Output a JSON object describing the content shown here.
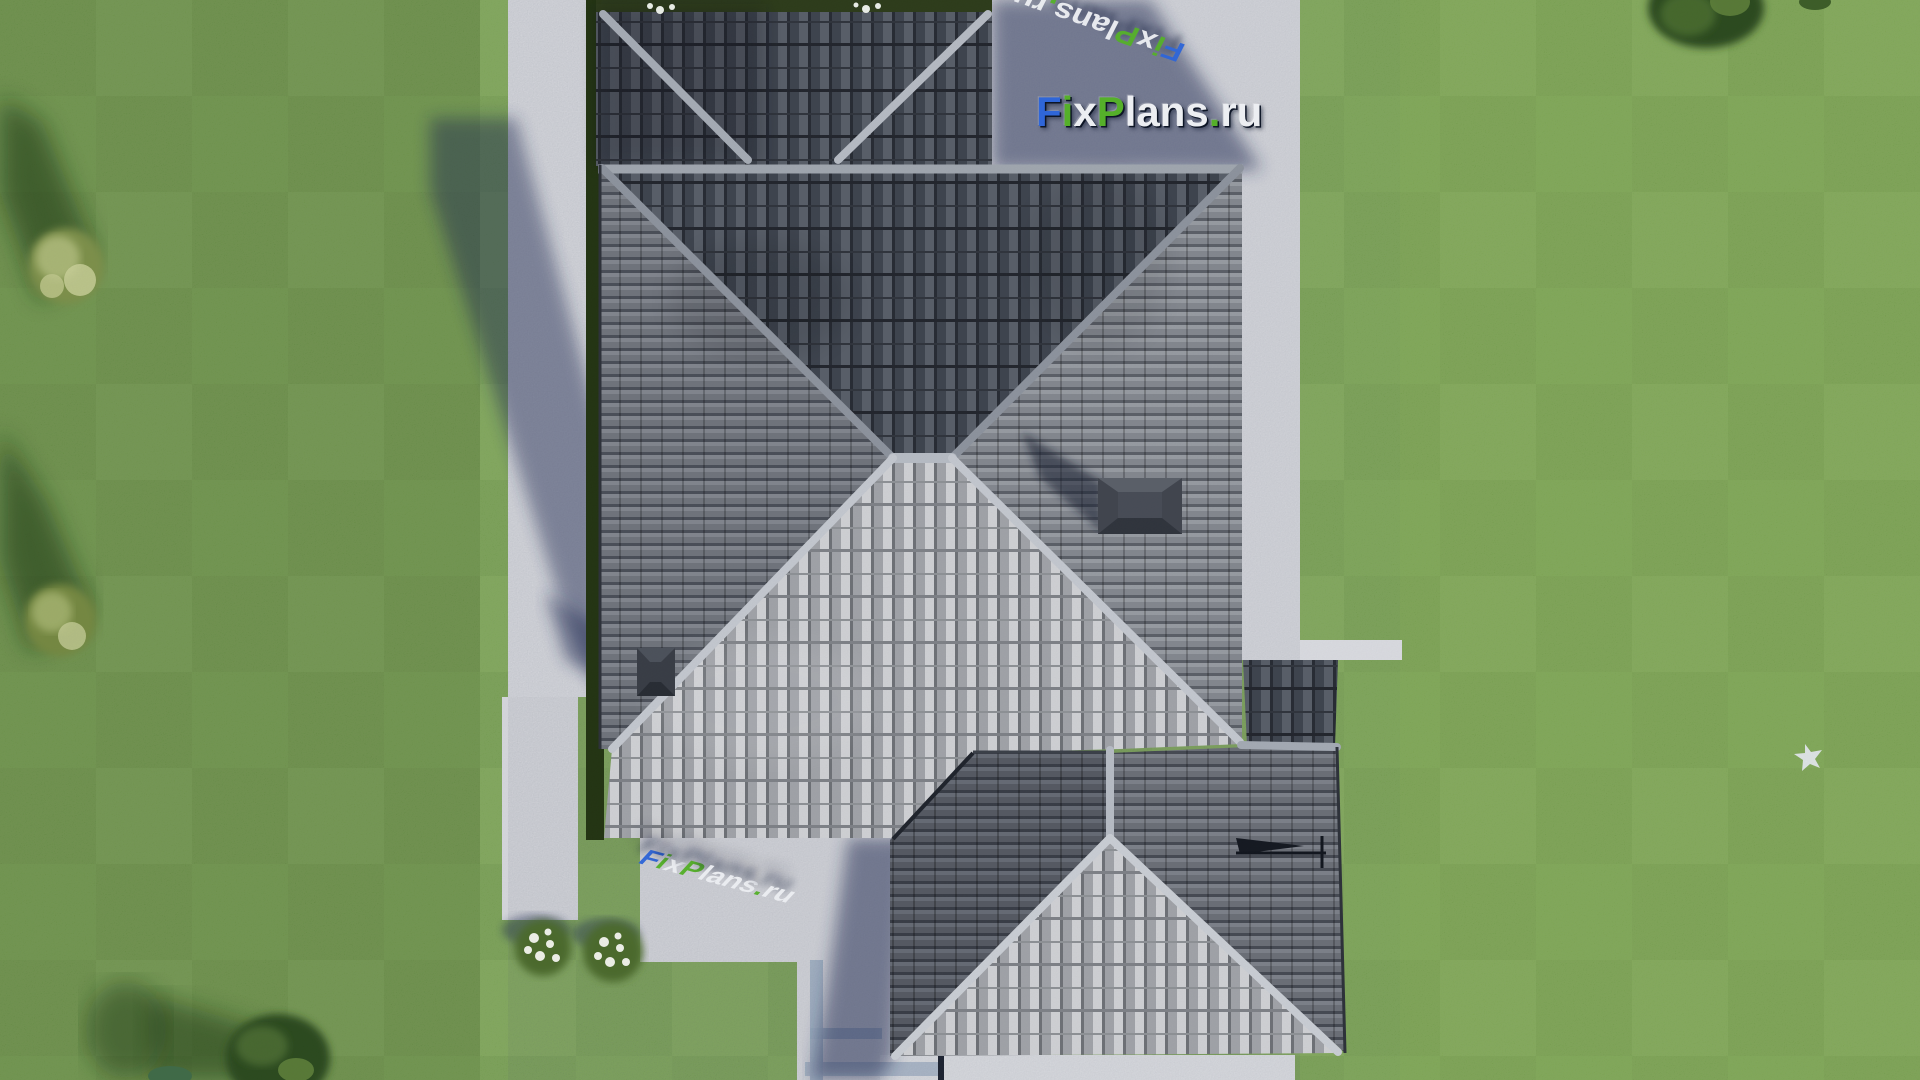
{
  "watermark": {
    "text": "FixPlans.ru",
    "segments": [
      {
        "text": "F",
        "css": "color:#2f66d8"
      },
      {
        "text": "i",
        "css": "color:#55b02a"
      },
      {
        "text": "x",
        "css": "color:#eceef2"
      },
      {
        "text": "P",
        "css": "color:#55b02a"
      },
      {
        "text": "lans",
        "css": "color:#eceef2"
      },
      {
        "text": ".",
        "css": "color:#55b02a"
      },
      {
        "text": "ru",
        "css": "color:#eceef2"
      }
    ],
    "colors": {
      "blue": "#2f66d8",
      "green": "#55b02a",
      "white": "#eceef2",
      "outline": "#101a2e"
    }
  },
  "palette": {
    "grass": "#6e9943",
    "grass_shaded": "#5c8a3a",
    "pavement": "#dcdde2",
    "cobble_path": "#9fb0c6",
    "shadow": "#1d2750",
    "roof_dark_slope": "#3d434d",
    "roof_bright_slope": "#c9cbce",
    "roof_medium_slope": "#84888f",
    "ridge_cap": "#c6cad1",
    "hedge": "#223310"
  },
  "objects": [
    "garage-hip-roof",
    "main-hip-roof",
    "rear-extension-hip-roof",
    "roof-vent",
    "chimney",
    "tv-antenna",
    "walkway",
    "patio",
    "flower-bush",
    "tree",
    "white-bird",
    "lawn",
    "building-shadow"
  ]
}
